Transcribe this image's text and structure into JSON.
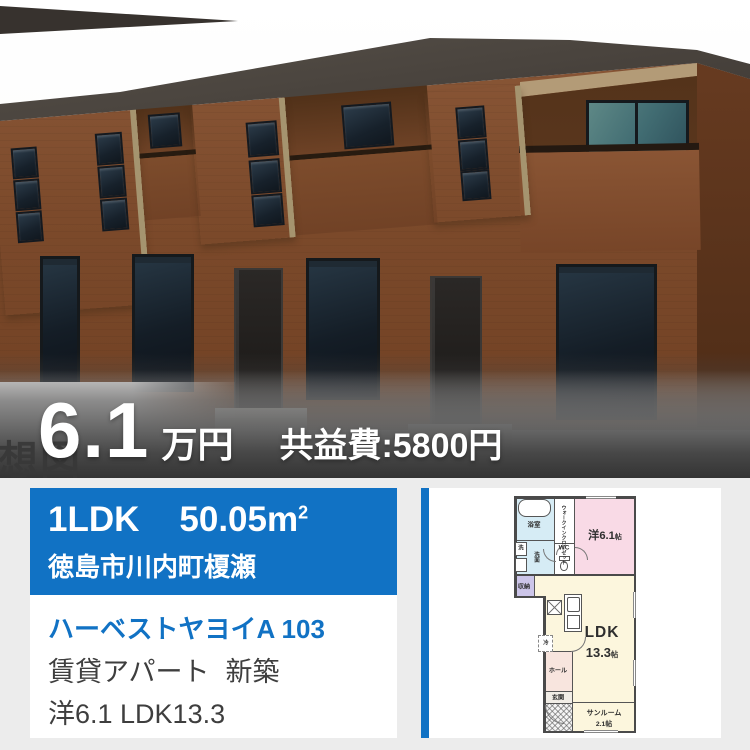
{
  "photo": {
    "watermark_text": "想図",
    "price": {
      "amount": "6.1",
      "unit": "万円",
      "fee": "共益費:5800円"
    }
  },
  "listing": {
    "layout": "1LDK",
    "area_value": "50.05m",
    "area_sup": "2",
    "address": "徳島市川内町榎瀬",
    "title": "ハーベストヤヨイA 103",
    "category": "賃貸アパート",
    "condition": "新築",
    "rooms": "洋6.1 LDK13.3"
  },
  "floorplan": {
    "bath": "浴室",
    "washer": "洗",
    "vanity": "洗面",
    "wic": "ウォークインクローゼット",
    "wc": "WC",
    "western_room": "洋6.1",
    "western_unit": "帖",
    "storage": "収納",
    "ldk_label": "LDK",
    "ldk_size": "13.3",
    "ldk_unit": "帖",
    "fridge": "冷",
    "hall": "ホール",
    "entrance": "玄関",
    "sunroom": "サンルーム",
    "sunroom_size": "2.1",
    "sunroom_unit": "帖"
  },
  "colors": {
    "accent_blue": "#1172c4",
    "link_blue": "#1172c4"
  }
}
